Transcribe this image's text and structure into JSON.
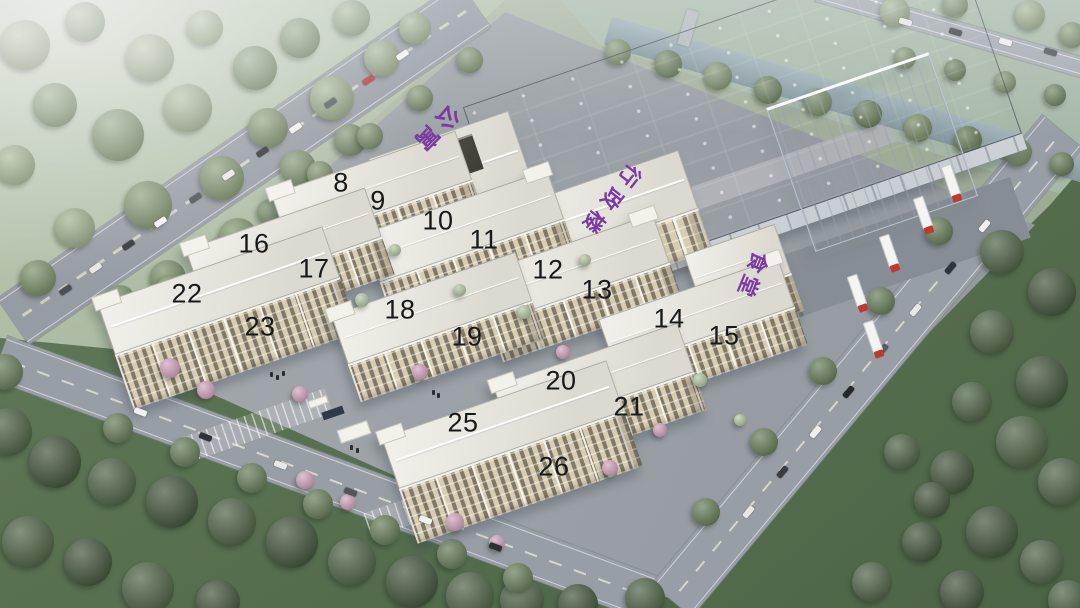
{
  "building_units": [
    "8",
    "9",
    "10",
    "11",
    "12",
    "13",
    "14",
    "15",
    "16",
    "17",
    "18",
    "19",
    "20",
    "21",
    "22",
    "23",
    "25",
    "26"
  ],
  "roof_labels": {
    "apartment": "公寓",
    "admin_building": "行政楼",
    "canteen": "食堂"
  },
  "colors": {
    "roof_label_purple": "#7a3aa2",
    "unit_number": "#17181a",
    "factory_wall_beige": "#d8ccb2",
    "factory_roof_white": "#e8e6de",
    "warehouse_roof_slate": "#6b7683",
    "vegetation_green": "#6d8360",
    "road_gray": "#989ea5",
    "river_blue": "#8fa5ad"
  }
}
